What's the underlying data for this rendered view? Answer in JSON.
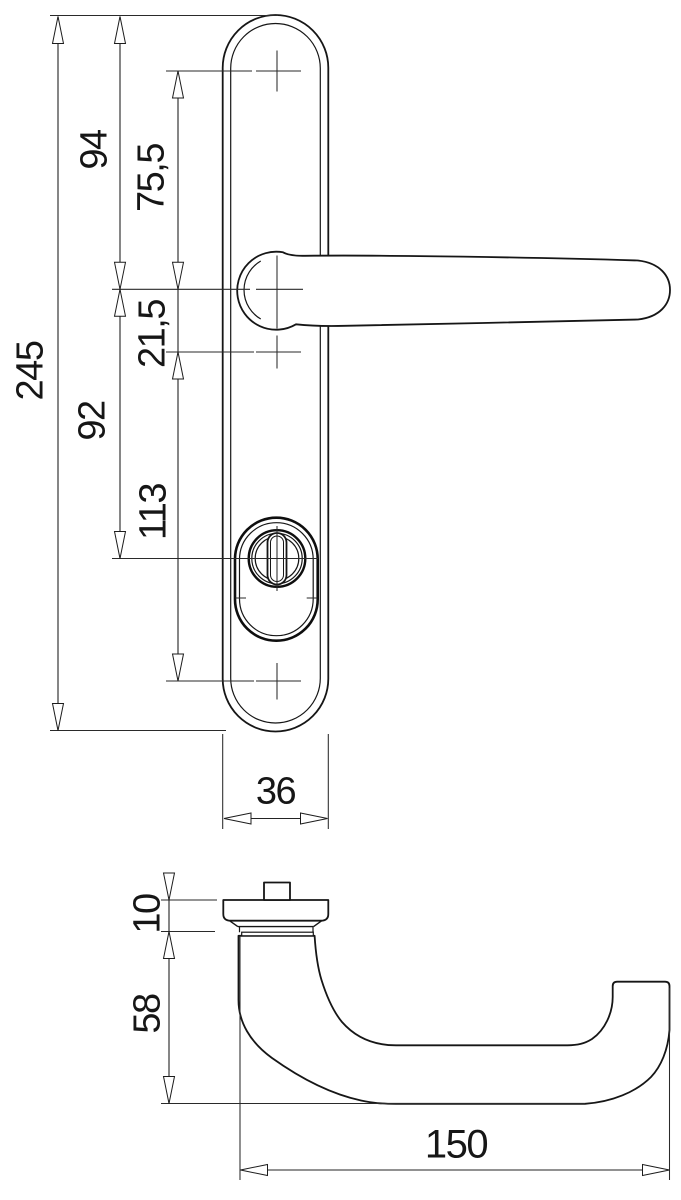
{
  "drawing": {
    "type": "technical-dimension-drawing",
    "subject": "door-lever-handle-with-long-backplate",
    "units_style": "decimal-comma",
    "line_color": "#161616",
    "background_color": "#ffffff",
    "front_view": {
      "dims": {
        "overall_height": "245",
        "top_to_handle_axis": "94",
        "top_hole_to_handle_axis": "75,5",
        "handle_axis_to_second_hole": "21,5",
        "handle_axis_to_cylinder": "92",
        "second_hole_to_bottom_hole": "113",
        "plate_width": "36"
      }
    },
    "side_view": {
      "dims": {
        "rose_height": "10",
        "neck_projection": "58",
        "handle_length": "150"
      }
    }
  }
}
